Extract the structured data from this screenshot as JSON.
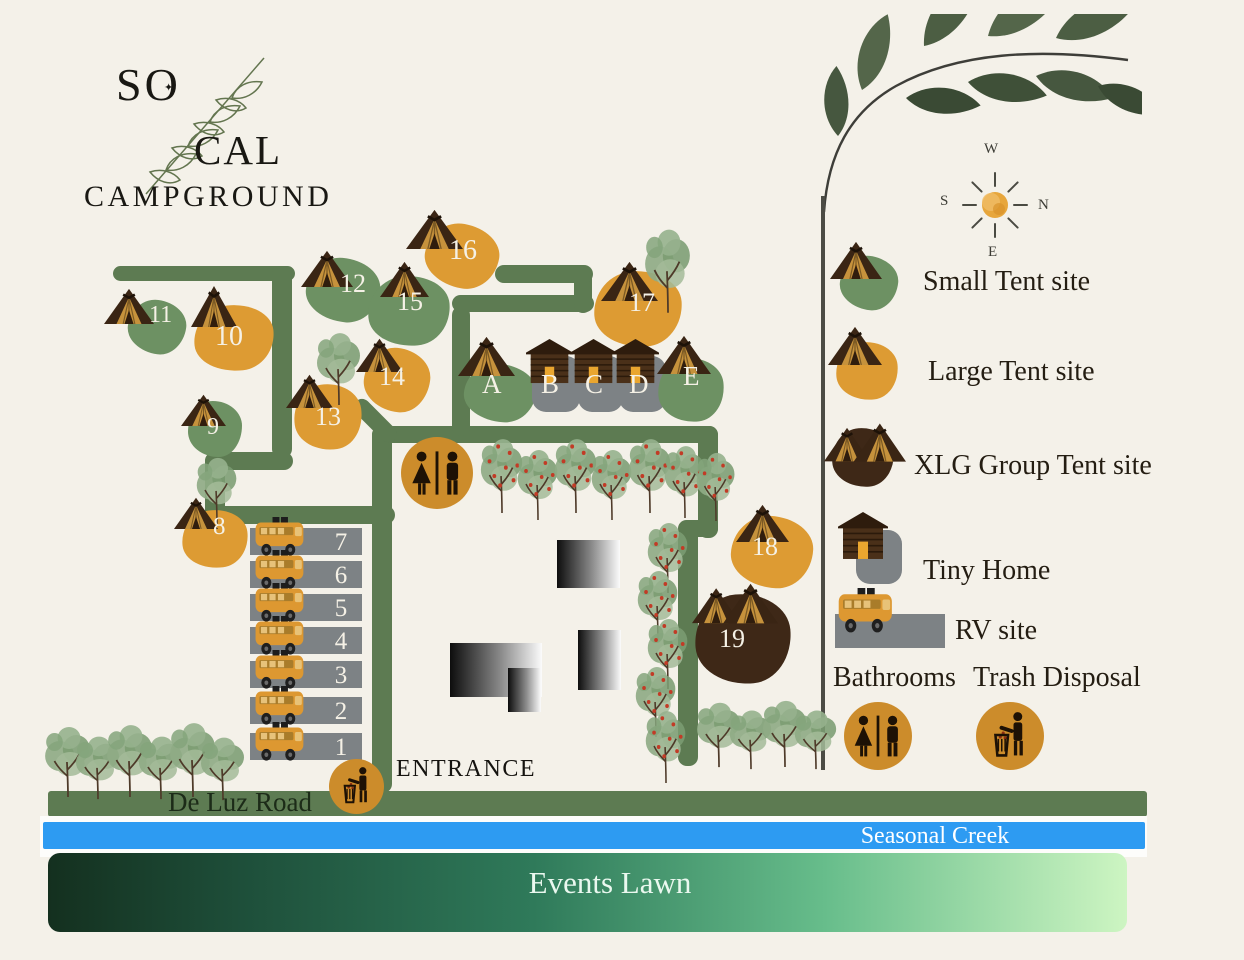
{
  "brand": {
    "line1": "SO",
    "o_star": "✦",
    "line2": "CAL",
    "line3": "CAMPGROUND"
  },
  "compass": {
    "top": "W",
    "left": "S",
    "right": "N",
    "bottom": "E"
  },
  "legend": {
    "items": [
      {
        "kind": "small",
        "label": "Small Tent site",
        "blob": [
          840,
          256,
          58,
          54,
          6
        ],
        "icon": [
          830,
          241,
          52,
          38
        ],
        "text": [
          923,
          268
        ]
      },
      {
        "kind": "large",
        "label": "Large Tent site",
        "blob": [
          836,
          342,
          62,
          58,
          -6
        ],
        "icon": [
          828,
          326,
          54,
          39
        ],
        "text": [
          928,
          358
        ]
      },
      {
        "kind": "xlg",
        "label": "XLG Group Tent site",
        "blob": [
          832,
          428,
          62,
          59,
          -4
        ],
        "icon": [
          824,
          420,
          82,
          46
        ],
        "text": [
          914,
          452
        ]
      },
      {
        "kind": "tiny",
        "label": "Tiny Home",
        "blob": [
          856,
          530,
          46,
          54,
          0
        ],
        "icon": [
          838,
          512,
          50,
          48
        ],
        "text": [
          923,
          557
        ]
      },
      {
        "kind": "rv",
        "label": "RV site",
        "blob": [
          835,
          614,
          110,
          34,
          0
        ],
        "icon": [
          837,
          588,
          60,
          46
        ],
        "text": [
          955,
          617
        ]
      },
      {
        "kind": "bath",
        "label": "Bathrooms",
        "circle": [
          844,
          702,
          68
        ],
        "text": [
          833,
          664
        ]
      },
      {
        "kind": "trash",
        "label": "Trash Disposal",
        "circle": [
          976,
          702,
          68
        ],
        "text": [
          973,
          664
        ]
      }
    ]
  },
  "map": {
    "labels": {
      "entrance": "ENTRANCE",
      "road": "De Luz Road",
      "creek": "Seasonal Creek",
      "lawn": "Events Lawn"
    },
    "roads": [
      [
        113,
        266,
        182,
        15,
        0
      ],
      [
        272,
        266,
        20,
        192,
        0
      ],
      [
        205,
        452,
        88,
        18,
        0
      ],
      [
        205,
        452,
        20,
        72,
        0
      ],
      [
        205,
        506,
        190,
        18,
        0
      ],
      [
        372,
        426,
        20,
        367,
        0
      ],
      [
        372,
        426,
        346,
        17,
        0
      ],
      [
        698,
        426,
        20,
        112,
        0
      ],
      [
        678,
        520,
        40,
        17,
        0
      ],
      [
        678,
        522,
        20,
        244,
        0
      ],
      [
        452,
        306,
        18,
        130,
        0
      ],
      [
        452,
        295,
        142,
        17,
        0
      ],
      [
        574,
        267,
        18,
        46,
        0
      ],
      [
        495,
        265,
        98,
        18,
        0
      ],
      [
        348,
        412,
        54,
        17,
        45
      ]
    ],
    "buildings": [
      [
        557,
        540,
        63,
        48
      ],
      [
        578,
        630,
        43,
        60
      ],
      [
        450,
        643,
        92,
        54
      ],
      [
        508,
        668,
        33,
        44
      ]
    ],
    "trees": [
      [
        478,
        436,
        48,
        78,
        1
      ],
      [
        515,
        447,
        46,
        74,
        1
      ],
      [
        552,
        436,
        48,
        78,
        1
      ],
      [
        589,
        447,
        46,
        74,
        1
      ],
      [
        626,
        436,
        48,
        78,
        1
      ],
      [
        662,
        443,
        46,
        76,
        1
      ],
      [
        694,
        450,
        44,
        72,
        1
      ],
      [
        645,
        520,
        46,
        74,
        1
      ],
      [
        635,
        568,
        46,
        74,
        1
      ],
      [
        645,
        616,
        46,
        74,
        1
      ],
      [
        633,
        664,
        46,
        74,
        1
      ],
      [
        643,
        708,
        46,
        76,
        1
      ],
      [
        314,
        330,
        50,
        76,
        0
      ],
      [
        194,
        455,
        46,
        70,
        0
      ],
      [
        642,
        226,
        52,
        88,
        0
      ],
      [
        42,
        724,
        52,
        74,
        0
      ],
      [
        73,
        734,
        50,
        66,
        0
      ],
      [
        104,
        722,
        52,
        76,
        0
      ],
      [
        136,
        734,
        50,
        66,
        0
      ],
      [
        167,
        720,
        52,
        78,
        0
      ],
      [
        198,
        735,
        50,
        66,
        0
      ],
      [
        694,
        700,
        50,
        68,
        0
      ],
      [
        727,
        708,
        48,
        62,
        0
      ],
      [
        760,
        698,
        50,
        70,
        0
      ],
      [
        792,
        708,
        48,
        62,
        0
      ]
    ],
    "sites": [
      {
        "id": "11",
        "kind": "small",
        "blob": [
          128,
          300,
          58,
          54,
          8
        ],
        "tent": [
          104,
          288,
          50,
          36
        ],
        "pos": [
          149,
          303,
          24
        ]
      },
      {
        "id": "10",
        "kind": "large",
        "blob": [
          194,
          305,
          80,
          66,
          -6
        ],
        "tent": [
          191,
          285,
          46,
          42
        ],
        "pos": [
          215,
          323,
          28
        ]
      },
      {
        "id": "12",
        "kind": "small",
        "blob": [
          306,
          258,
          74,
          64,
          5
        ],
        "tent": [
          301,
          250,
          52,
          37
        ],
        "pos": [
          340,
          271,
          26
        ]
      },
      {
        "id": "9",
        "kind": "small",
        "blob": [
          188,
          401,
          54,
          56,
          0
        ],
        "tent": [
          181,
          394,
          45,
          32
        ],
        "pos": [
          207,
          415,
          24
        ]
      },
      {
        "id": "13",
        "kind": "large",
        "blob": [
          294,
          384,
          68,
          66,
          -8
        ],
        "tent": [
          286,
          374,
          47,
          34
        ],
        "pos": [
          315,
          404,
          26
        ]
      },
      {
        "id": "14",
        "kind": "large",
        "blob": [
          364,
          348,
          66,
          64,
          6
        ],
        "tent": [
          356,
          338,
          47,
          34
        ],
        "pos": [
          379,
          364,
          26
        ]
      },
      {
        "id": "15",
        "kind": "small",
        "blob": [
          368,
          276,
          82,
          70,
          -5
        ],
        "tent": [
          380,
          261,
          49,
          36
        ],
        "pos": [
          397,
          289,
          26
        ]
      },
      {
        "id": "16",
        "kind": "large",
        "blob": [
          425,
          224,
          74,
          64,
          10
        ],
        "tent": [
          406,
          209,
          57,
          40
        ],
        "pos": [
          449,
          237,
          28
        ]
      },
      {
        "id": "17",
        "kind": "large",
        "blob": [
          594,
          271,
          88,
          76,
          -4
        ],
        "tent": [
          601,
          261,
          57,
          40
        ],
        "pos": [
          629,
          290,
          26
        ]
      },
      {
        "id": "8",
        "kind": "large",
        "blob": [
          182,
          510,
          66,
          58,
          -7
        ],
        "tent": [
          174,
          497,
          44,
          32
        ],
        "pos": [
          213,
          514,
          25
        ]
      },
      {
        "id": "18",
        "kind": "large",
        "blob": [
          731,
          516,
          82,
          72,
          3
        ],
        "tent": [
          736,
          504,
          53,
          38
        ],
        "pos": [
          752,
          534,
          26
        ]
      },
      {
        "id": "19",
        "kind": "xlg",
        "blob": [
          695,
          594,
          96,
          90,
          -5
        ],
        "tent": [
          692,
          580,
          86,
          48
        ],
        "pos": [
          719,
          626,
          26
        ]
      },
      {
        "id": "A",
        "kind": "small",
        "blob": [
          464,
          364,
          72,
          58,
          4
        ],
        "tent": [
          458,
          336,
          57,
          40
        ],
        "pos": [
          482,
          371,
          27
        ]
      },
      {
        "id": "B",
        "kind": "tiny",
        "blob": [
          532,
          356,
          48,
          56,
          0
        ],
        "tent": [
          526,
          339,
          47,
          45
        ],
        "pos": [
          541,
          371,
          27
        ]
      },
      {
        "id": "C",
        "kind": "tiny",
        "blob": [
          578,
          356,
          45,
          56,
          0
        ],
        "tent": [
          570,
          339,
          47,
          45
        ],
        "pos": [
          585,
          371,
          27
        ]
      },
      {
        "id": "D",
        "kind": "tiny",
        "blob": [
          619,
          356,
          47,
          56,
          0
        ],
        "tent": [
          612,
          339,
          47,
          45
        ],
        "pos": [
          629,
          371,
          27
        ]
      },
      {
        "id": "E",
        "kind": "small",
        "blob": [
          658,
          358,
          66,
          64,
          -6
        ],
        "tent": [
          657,
          335,
          54,
          39
        ],
        "pos": [
          683,
          363,
          27
        ]
      }
    ],
    "rv": {
      "x": 250,
      "w": 112,
      "h": 27,
      "ys": [
        528,
        561,
        594,
        627,
        661,
        697,
        733
      ],
      "labels": [
        "7",
        "6",
        "5",
        "4",
        "3",
        "2",
        "1"
      ]
    },
    "circles": {
      "bath": [
        401,
        437,
        72
      ],
      "trash": [
        329,
        759,
        55
      ]
    }
  },
  "colors": {
    "road": "#5d7b52",
    "small": "#6d9163",
    "large": "#dd9b33",
    "xlg": "#3e2817",
    "pad": "#7d8285",
    "circle": "#cc8c2b",
    "creek": "#2d9bf2",
    "background": "#f4f1e9",
    "lawn_dark": "#14301f",
    "lawn_light": "#cdf5c2",
    "tent_dark": "#3a2514",
    "tent_canvas": "#c6923c"
  }
}
